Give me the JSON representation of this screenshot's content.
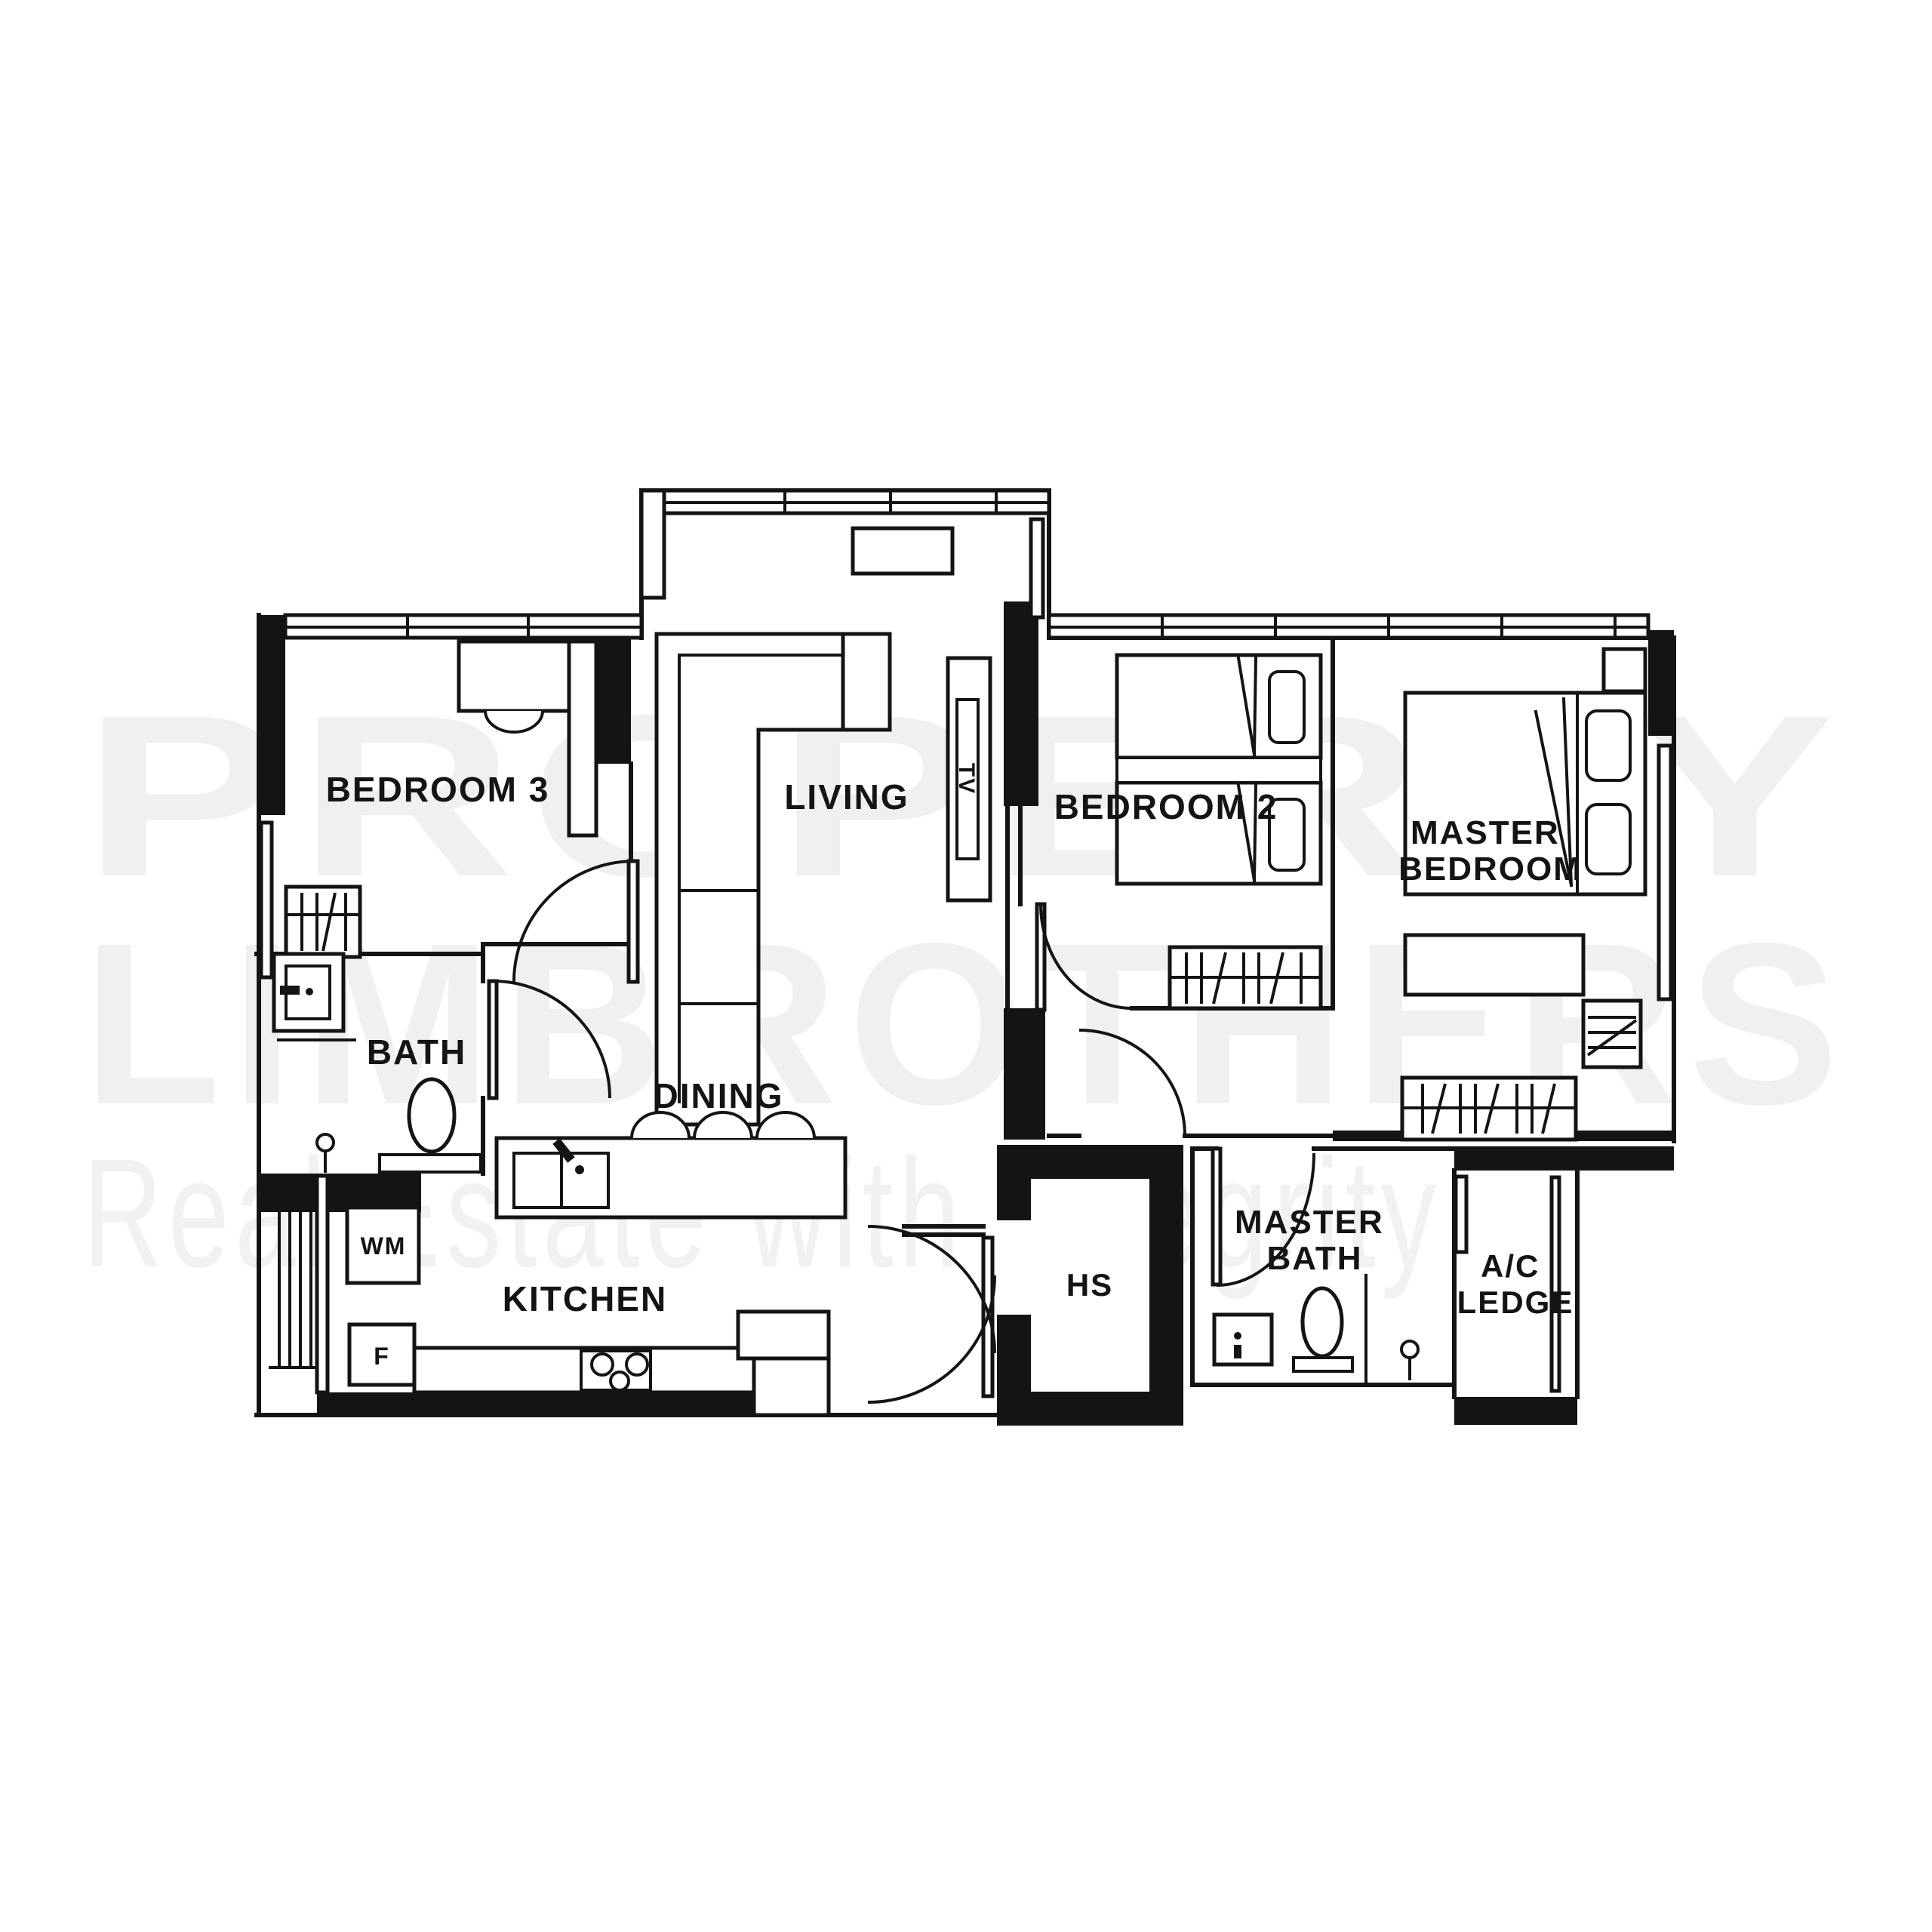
{
  "watermark": {
    "line1": "PROPERTY",
    "line2": "LIMBROTHERS",
    "tagline": "Real Estate with Integrity",
    "color_big": "#f0f0f0",
    "color_tagline": "#f1f1f1"
  },
  "floor_plan": {
    "colors": {
      "background": "#ffffff",
      "wall": "#141414",
      "label": "#141414"
    },
    "labels": {
      "bedroom3": "BEDROOM 3",
      "living": "LIVING",
      "tv": "TV",
      "bedroom2": "BEDROOM 2",
      "master_bedroom": [
        "MASTER",
        "BEDROOM"
      ],
      "bath": "BATH",
      "dining": "DINING",
      "master_bath": [
        "MASTER",
        "BATH"
      ],
      "kitchen": "KITCHEN",
      "hs": "HS",
      "ac_ledge": [
        "A/C",
        "LEDGE"
      ],
      "wm": "WM",
      "fridge": "F"
    },
    "fixtures": [
      "sofa",
      "tv-console",
      "shoe-cabinet",
      "desk",
      "wardrobe",
      "single-bed",
      "double-bed",
      "pillow",
      "nightstand",
      "dresser",
      "toilet",
      "sink",
      "shower-head",
      "dining-island",
      "island-sink",
      "bar-chair",
      "washing-machine",
      "fridge",
      "stove",
      "service-yard-rail",
      "door-swing",
      "window"
    ]
  }
}
